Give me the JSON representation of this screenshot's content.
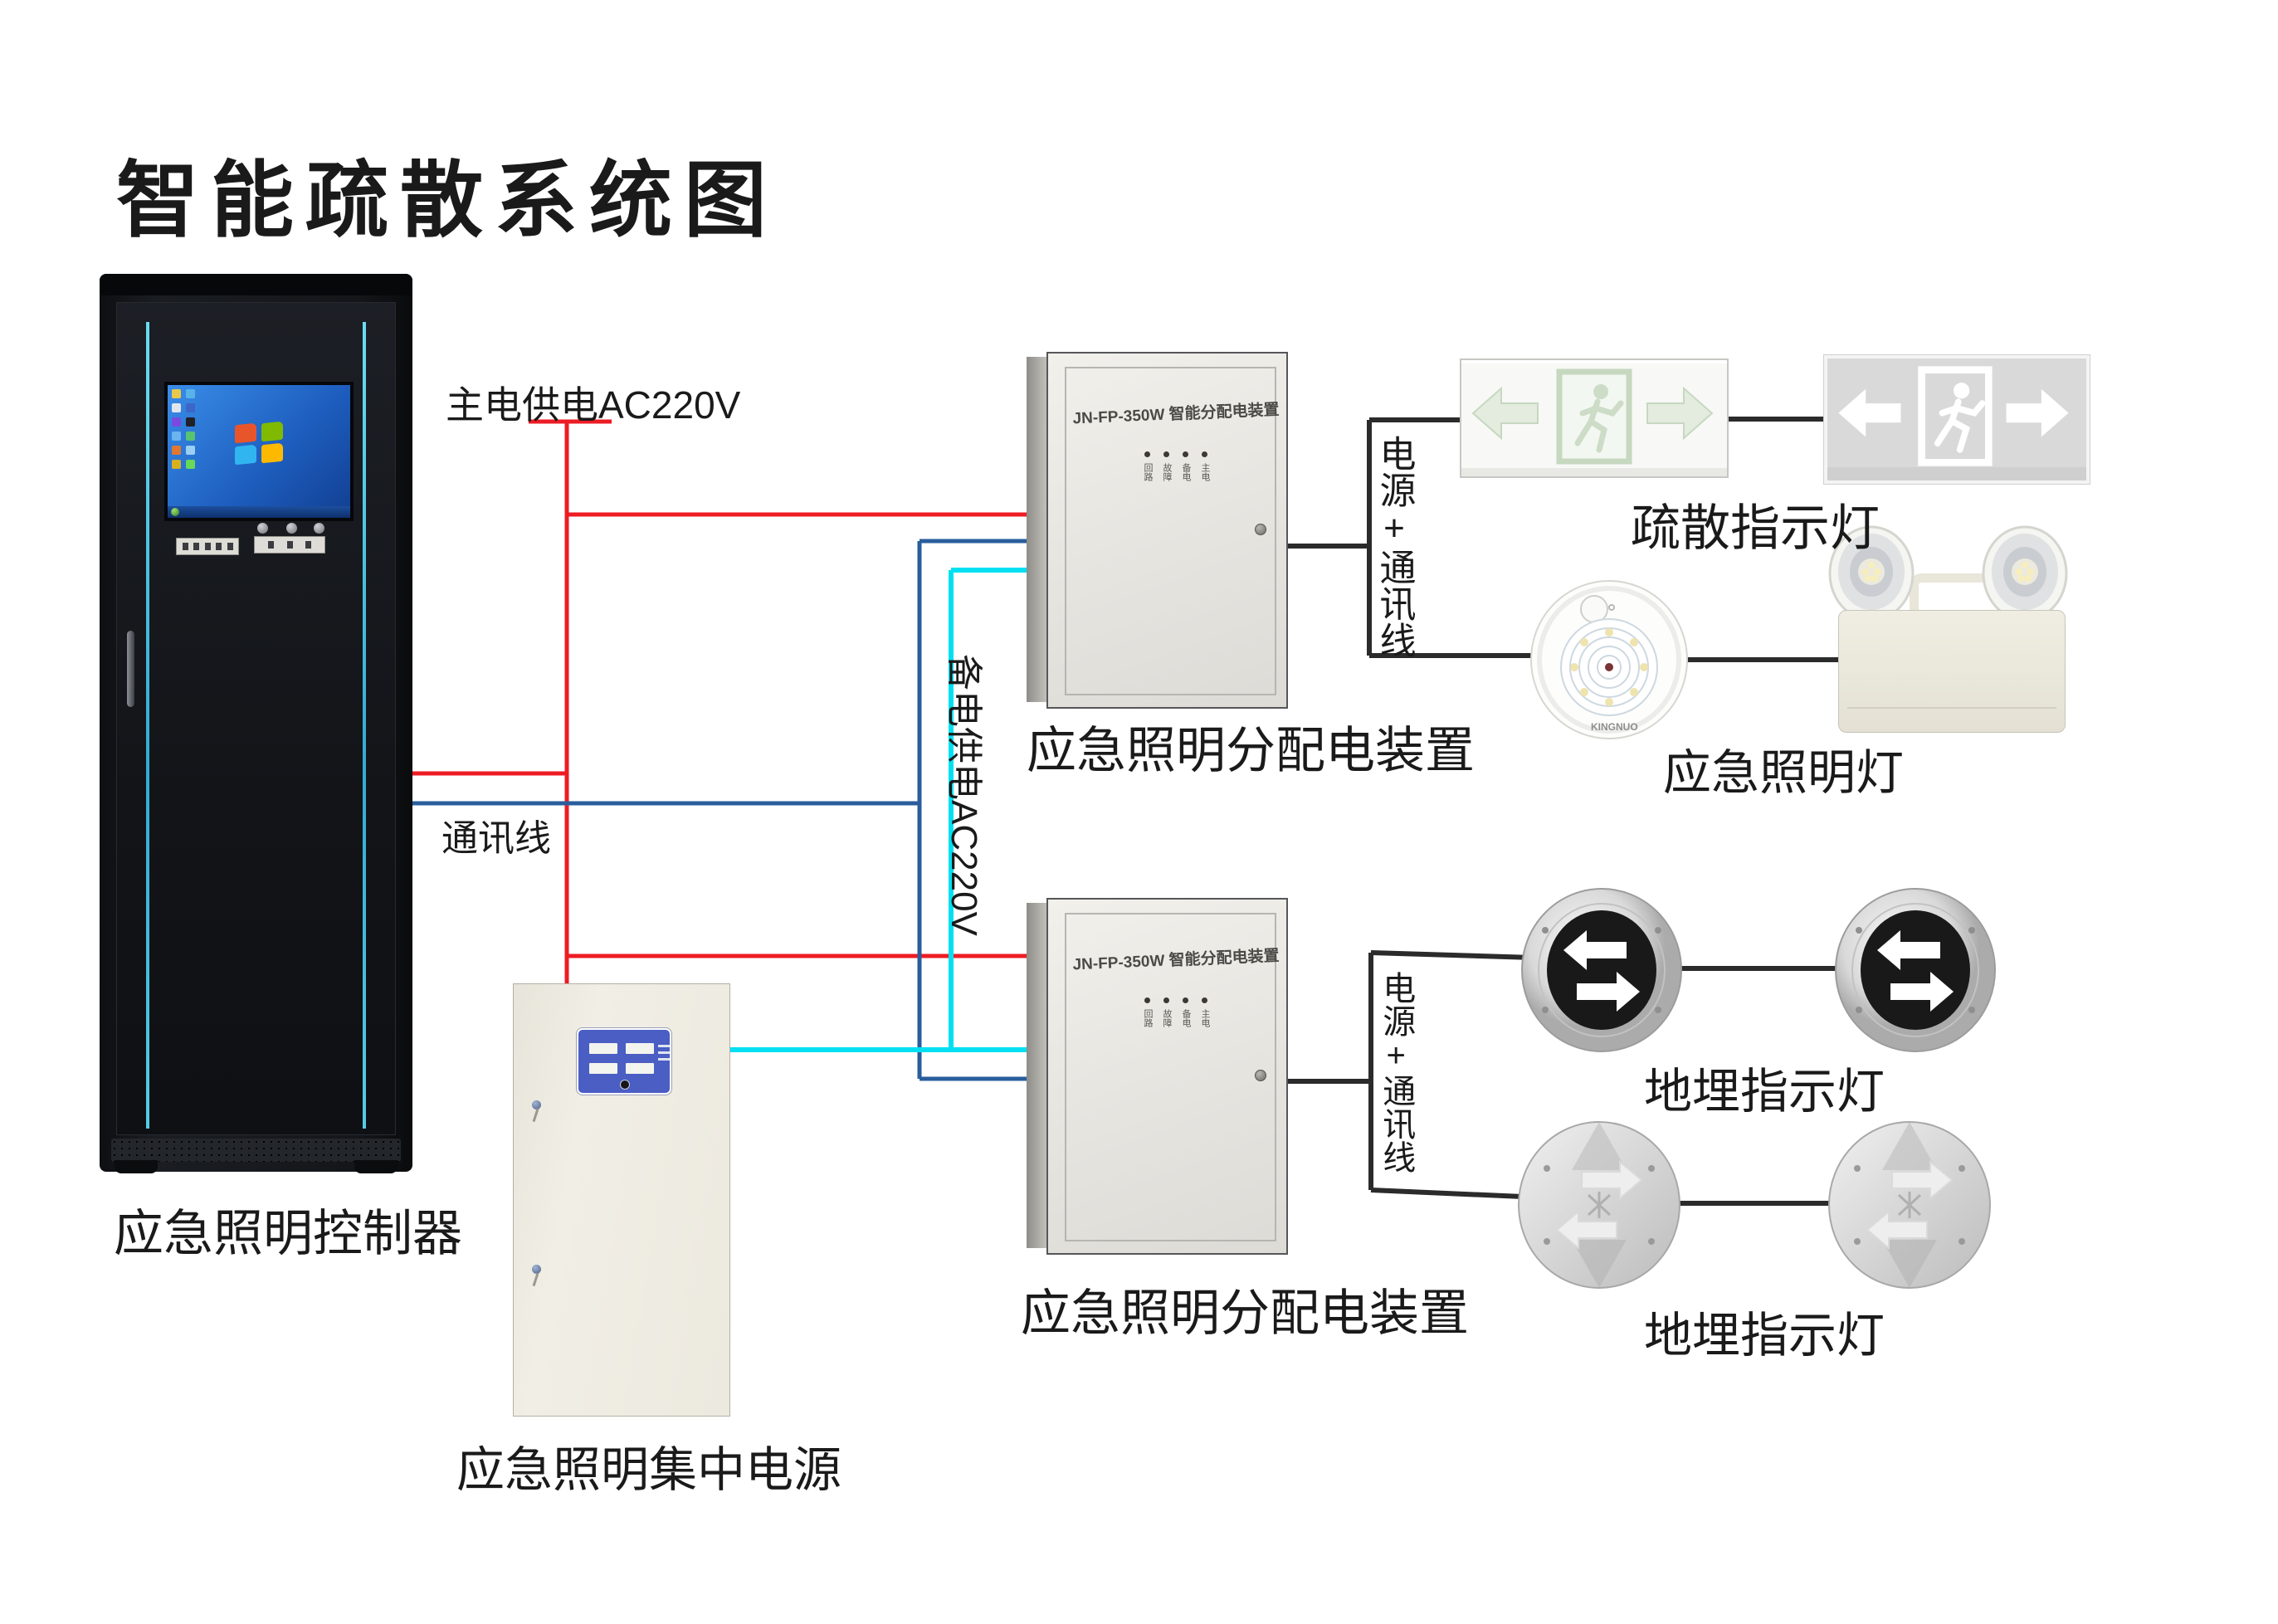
{
  "title": "智能疏散系统图",
  "wire_labels": {
    "main_power": "主电供电AC220V",
    "comm": "通讯线",
    "backup_power": "备电供电AC220V",
    "power_comm_top": "电源+通讯线",
    "power_comm_bottom": "电源+通讯线"
  },
  "device_labels": {
    "controller": "应急照明控制器",
    "central_power": "应急照明集中电源",
    "distribution_top": "应急照明分配电装置",
    "distribution_bottom": "应急照明分配电装置",
    "exit_signs": "疏散指示灯",
    "emergency_lights": "应急照明灯",
    "ground_lights_top": "地埋指示灯",
    "ground_lights_bottom": "地埋指示灯"
  },
  "distribution_box": {
    "header": "JN-FP-350W 智能分配电装置",
    "indicators": [
      "回路",
      "故障",
      "备电",
      "主电"
    ]
  },
  "emergency_lamp": {
    "brand": "KINGNUO"
  },
  "colors": {
    "main_power_wire": "#ed1c24",
    "comm_wire": "#2a5d9c",
    "backup_wire": "#00e0f2",
    "connector_wire": "#2b2b2b"
  }
}
